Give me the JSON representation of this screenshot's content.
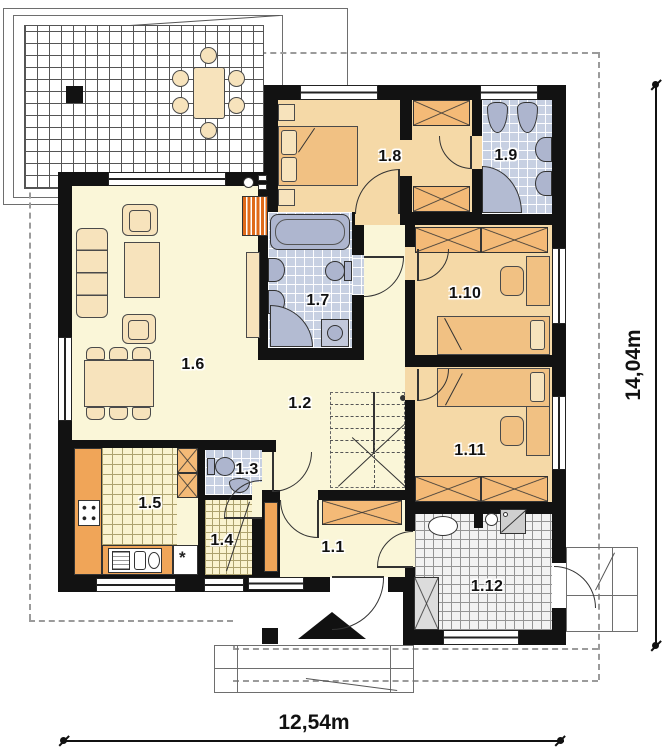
{
  "plan": {
    "title": "house-ground-floor-plan",
    "room_labels": [
      "1.1",
      "1.2",
      "1.3",
      "1.4",
      "1.5",
      "1.6",
      "1.7",
      "1.8",
      "1.9",
      "1.10",
      "1.11",
      "1.12"
    ],
    "dimensions": {
      "width": "12,54m",
      "height": "14,04m"
    },
    "symbols": {
      "kitchen_asterisk": "*"
    },
    "colors": {
      "wall": "#121212",
      "room_cream": "#FAF6D8",
      "room_peach": "#F5D9A7",
      "wardrobe_orange": "#F4BA77",
      "counter_orange": "#F0A558",
      "fireplace_orange": "#DF6A1A",
      "bath_tile_blue": "#C7D0E2",
      "fixture_gray": "#ADB5CE",
      "utility_tile_gray": "#F2F2F2",
      "roofline_dash_gray": "#9B9B9B"
    }
  }
}
